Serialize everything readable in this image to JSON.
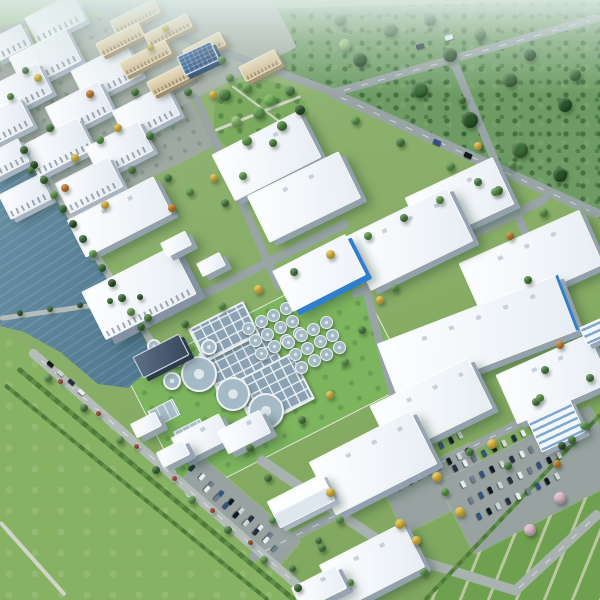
{
  "scene": {
    "size": [
      600,
      600
    ],
    "palette": {
      "ground": "#86ac64",
      "forest": "#6d9b63",
      "field": "#87b163",
      "crop": "#6fa04f",
      "crop_stripe": "#b9c8a0",
      "water_light": "#6d93a6",
      "water_dark": "#35566f",
      "road": "#98a5a4",
      "road_light": "#b5bdbb",
      "roof_white": "#f6f9fc",
      "facade_shadow": "#a9b4c2",
      "accent_blue": "#2f7fd0",
      "solar_blue": "#1c3e69",
      "dorm_tan": "#cdb78d",
      "lawn": "#7db45e",
      "tank_rim": "#eef2f5",
      "tank_water": "#a5bac7",
      "haze": "#dfece9"
    },
    "tree_palette": [
      "#4c8040",
      "#3a6b36",
      "#5f9a4c",
      "#2a5429",
      "#6fae58",
      "#e0bc3f",
      "#c9822e",
      "#a84b2d",
      "#d9b8c9",
      "#8fbf72"
    ],
    "car_palette": [
      "#223140",
      "#e8edf1",
      "#6f8091",
      "#32527e",
      "#101820",
      "#cfd6db"
    ],
    "pads": [
      [
        82,
        118,
        210,
        170,
        -27,
        "pad"
      ],
      [
        185,
        48,
        200,
        100,
        -27,
        "padl"
      ],
      [
        268,
        378,
        250,
        135,
        -27,
        "lawn"
      ],
      [
        175,
        85,
        45,
        18,
        -27,
        "lot"
      ],
      [
        240,
        512,
        130,
        34,
        41,
        "lot"
      ],
      [
        438,
        488,
        100,
        52,
        -27,
        "lot"
      ],
      [
        532,
        480,
        170,
        80,
        -27,
        "lot"
      ]
    ],
    "roads_a": [
      [
        330,
        92,
        600,
        215,
        10,
        "road",
        1
      ],
      [
        333,
        93,
        600,
        17,
        8,
        "road",
        1
      ],
      [
        95,
        5,
        338,
        94,
        8,
        "road",
        0
      ],
      [
        0,
        30,
        98,
        6,
        7,
        "road",
        0
      ],
      [
        136,
        328,
        348,
        222,
        9,
        "road",
        0
      ],
      [
        352,
        295,
        548,
        197,
        9,
        "road",
        0
      ],
      [
        250,
        558,
        600,
        382,
        9,
        "road",
        1
      ],
      [
        195,
        95,
        280,
        290,
        8,
        "road",
        0
      ],
      [
        360,
        265,
        402,
        430,
        8,
        "road",
        0
      ],
      [
        452,
        58,
        545,
        280,
        8,
        "road",
        0
      ],
      [
        548,
        288,
        595,
        390,
        8,
        "road",
        0
      ],
      [
        215,
        130,
        300,
        96,
        2.5,
        "path",
        0
      ],
      [
        232,
        86,
        288,
        128,
        2,
        "path",
        0
      ]
    ],
    "roads_b": [
      [
        26,
        146,
        152,
        342,
        7,
        "roadl",
        0
      ],
      [
        30,
        350,
        315,
        600,
        9,
        "roadl",
        1
      ],
      [
        0,
        318,
        150,
        297,
        5,
        "roadl",
        0
      ],
      [
        258,
        458,
        400,
        555,
        10,
        "roadm",
        0
      ],
      [
        395,
        553,
        520,
        592,
        10,
        "roadm",
        0
      ],
      [
        515,
        591,
        600,
        512,
        10,
        "roadm",
        1
      ],
      [
        0,
        522,
        65,
        595,
        4,
        "path",
        0
      ],
      [
        18,
        368,
        295,
        600,
        5,
        "hedge",
        0
      ],
      [
        5,
        385,
        268,
        600,
        4,
        "hedge",
        0
      ],
      [
        425,
        600,
        600,
        415,
        4,
        "hedge",
        0
      ]
    ],
    "buildings": [
      [
        54,
        18,
        52,
        28,
        -27,
        "m"
      ],
      [
        8,
        42,
        36,
        22,
        -27,
        "m"
      ],
      [
        44,
        58,
        62,
        34,
        -27,
        "m"
      ],
      [
        17,
        90,
        58,
        32,
        -27,
        "m"
      ],
      [
        2,
        122,
        50,
        30,
        -27,
        "m"
      ],
      [
        105,
        72,
        60,
        34,
        -27,
        "m"
      ],
      [
        78,
        108,
        58,
        32,
        -27,
        "m"
      ],
      [
        57,
        146,
        60,
        34,
        -27,
        "m"
      ],
      [
        5,
        158,
        38,
        24,
        -27,
        "m"
      ],
      [
        145,
        112,
        58,
        32,
        -27,
        "m"
      ],
      [
        118,
        148,
        58,
        32,
        -27,
        "m"
      ],
      [
        88,
        184,
        58,
        32,
        -27,
        "m"
      ],
      [
        24,
        196,
        44,
        26,
        -27,
        "m"
      ],
      [
        134,
        15,
        48,
        13,
        -27,
        "d"
      ],
      [
        119,
        38,
        46,
        13,
        -27,
        "d"
      ],
      [
        167,
        29,
        46,
        13,
        -27,
        "d"
      ],
      [
        144,
        57,
        50,
        14,
        -27,
        "d"
      ],
      [
        171,
        77,
        48,
        14,
        -27,
        "d"
      ],
      [
        203,
        46,
        40,
        13,
        -27,
        "d"
      ],
      [
        259,
        64,
        38,
        15,
        -27,
        "d"
      ],
      [
        197,
        57,
        36,
        19,
        -25,
        "s"
      ],
      [
        118,
        216,
        95,
        40,
        -27,
        "w"
      ],
      [
        138,
        292,
        100,
        52,
        -27,
        "p"
      ],
      [
        265,
        155,
        95,
        50,
        -27,
        "w"
      ],
      [
        303,
        196,
        100,
        50,
        -26,
        "w"
      ],
      [
        458,
        200,
        95,
        50,
        -25,
        "w"
      ],
      [
        530,
        263,
        130,
        58,
        -24,
        "w"
      ],
      [
        408,
        238,
        112,
        58,
        -26,
        "w"
      ],
      [
        318,
        272,
        80,
        44,
        -27,
        "b"
      ],
      [
        476,
        336,
        190,
        58,
        -21,
        "W"
      ],
      [
        552,
        378,
        100,
        52,
        -24,
        "w"
      ],
      [
        430,
        406,
        108,
        54,
        -26,
        "w"
      ],
      [
        372,
        462,
        112,
        58,
        -27,
        "w"
      ],
      [
        371,
        565,
        92,
        48,
        -27,
        "w"
      ],
      [
        200,
        437,
        52,
        26,
        -27,
        "w"
      ],
      [
        243,
        431,
        46,
        24,
        -27,
        "w"
      ],
      [
        318,
        587,
        48,
        24,
        -27,
        "w"
      ],
      [
        300,
        500,
        60,
        28,
        -27,
        "g"
      ],
      [
        555,
        425,
        46,
        34,
        -25,
        "o"
      ],
      [
        595,
        330,
        26,
        18,
        -24,
        "o"
      ],
      [
        160,
        355,
        50,
        22,
        -27,
        "t"
      ],
      [
        175,
        243,
        26,
        14,
        -27,
        "w"
      ],
      [
        210,
        263,
        24,
        13,
        -27,
        "w"
      ],
      [
        145,
        424,
        26,
        14,
        -27,
        "w"
      ],
      [
        172,
        452,
        28,
        15,
        -27,
        "w"
      ]
    ],
    "treatment": {
      "tanks": [
        [
          197,
          372,
          16
        ],
        [
          231,
          392,
          15
        ],
        [
          264,
          409,
          16
        ],
        [
          170,
          379,
          7
        ],
        [
          174,
          357,
          6
        ],
        [
          152,
          344,
          5
        ],
        [
          207,
          345,
          6
        ]
      ],
      "clusters": [
        [
          273,
          330,
          4,
          3,
          14,
          5.5,
          -27
        ],
        [
          313,
          344,
          4,
          3,
          14,
          5.5,
          -27
        ]
      ],
      "basins": [
        [
          239,
          357,
          68,
          44,
          -27
        ],
        [
          271,
          389,
          64,
          48,
          -27
        ],
        [
          222,
          330,
          58,
          34,
          -27
        ]
      ],
      "pools": [
        [
          163,
          412,
          26,
          16,
          -27
        ],
        [
          190,
          433,
          28,
          18,
          -27
        ]
      ]
    },
    "car_rows": [
      [
        455,
        468,
        -27,
        11,
        11,
        1,
        1
      ],
      [
        463,
        484,
        -27,
        11,
        11,
        1,
        1
      ],
      [
        471,
        500,
        -27,
        10,
        11,
        1,
        1
      ],
      [
        479,
        516,
        -27,
        9,
        11,
        1,
        1
      ],
      [
        392,
        470,
        -27,
        8,
        11,
        1,
        1
      ],
      [
        400,
        486,
        -27,
        8,
        11,
        1,
        1
      ],
      [
        192,
        468,
        41,
        9,
        13,
        1,
        1
      ],
      [
        207,
        489,
        41,
        8,
        13,
        1,
        1
      ],
      [
        158,
        82,
        -27,
        6,
        8,
        1,
        0.8
      ],
      [
        437,
        142,
        24,
        3,
        34,
        0,
        1.3
      ],
      [
        50,
        364,
        41,
        4,
        14,
        0,
        1
      ],
      [
        556,
        303,
        65,
        3,
        18,
        0,
        1
      ],
      [
        420,
        46,
        -16,
        2,
        30,
        0,
        1.2
      ]
    ],
    "trees": [
      [
        24,
        150,
        4,
        1
      ],
      [
        34,
        165,
        4,
        3
      ],
      [
        44,
        180,
        4,
        1
      ],
      [
        54,
        195,
        4,
        2
      ],
      [
        63,
        209,
        4,
        1
      ],
      [
        73,
        224,
        4,
        3
      ],
      [
        83,
        239,
        4,
        1
      ],
      [
        93,
        254,
        4,
        2
      ],
      [
        102,
        268,
        4,
        1
      ],
      [
        112,
        283,
        4,
        3
      ],
      [
        122,
        298,
        4,
        1
      ],
      [
        131,
        312,
        4,
        2
      ],
      [
        141,
        327,
        4,
        1
      ],
      [
        20,
        313,
        3,
        3
      ],
      [
        50,
        309,
        3,
        1
      ],
      [
        80,
        305,
        3,
        3
      ],
      [
        110,
        301,
        3,
        1
      ],
      [
        140,
        297,
        3,
        3
      ],
      [
        48,
        378,
        4,
        2
      ],
      [
        84,
        408,
        4,
        0
      ],
      [
        120,
        440,
        4,
        2
      ],
      [
        156,
        470,
        4,
        1
      ],
      [
        192,
        500,
        4,
        2
      ],
      [
        228,
        530,
        4,
        0
      ],
      [
        264,
        560,
        4,
        2
      ],
      [
        298,
        588,
        4,
        1
      ],
      [
        60,
        381,
        2.5,
        7
      ],
      [
        98,
        413,
        2.5,
        7
      ],
      [
        136,
        446,
        2.5,
        7
      ],
      [
        174,
        478,
        2.5,
        7
      ],
      [
        212,
        510,
        2.5,
        7
      ],
      [
        250,
        542,
        2.5,
        7
      ],
      [
        225,
        95,
        6,
        0
      ],
      [
        247,
        88,
        5,
        2
      ],
      [
        270,
        100,
        6,
        4
      ],
      [
        290,
        91,
        5,
        0
      ],
      [
        236,
        121,
        5,
        9
      ],
      [
        259,
        113,
        6,
        2
      ],
      [
        282,
        126,
        5,
        0
      ],
      [
        300,
        110,
        5,
        3
      ],
      [
        247,
        141,
        5,
        2
      ],
      [
        273,
        143,
        4,
        0
      ],
      [
        38,
        78,
        4,
        5
      ],
      [
        90,
        94,
        4,
        6
      ],
      [
        118,
        128,
        4,
        5
      ],
      [
        75,
        158,
        4,
        5
      ],
      [
        50,
        128,
        4,
        0
      ],
      [
        25,
        70,
        3.5,
        0
      ],
      [
        100,
        140,
        4,
        2
      ],
      [
        135,
        92,
        4,
        0
      ],
      [
        10,
        96,
        3.5,
        2
      ],
      [
        150,
        136,
        4,
        0
      ],
      [
        65,
        188,
        4,
        6
      ],
      [
        30,
        170,
        3.5,
        0
      ],
      [
        132,
        170,
        4,
        0
      ],
      [
        105,
        205,
        4,
        5
      ],
      [
        165,
        28,
        3.5,
        5
      ],
      [
        150,
        47,
        3.5,
        5
      ],
      [
        222,
        60,
        4,
        0
      ],
      [
        230,
        78,
        4,
        2
      ],
      [
        188,
        92,
        4,
        0
      ],
      [
        213,
        95,
        4,
        5
      ],
      [
        168,
        178,
        4,
        0
      ],
      [
        190,
        192,
        4,
        2
      ],
      [
        214,
        178,
        4,
        5
      ],
      [
        172,
        208,
        4,
        6
      ],
      [
        225,
        203,
        4,
        0
      ],
      [
        243,
        176,
        4,
        2
      ],
      [
        355,
        120,
        4.5,
        2
      ],
      [
        400,
        142,
        4.5,
        0
      ],
      [
        450,
        166,
        4.5,
        2
      ],
      [
        498,
        190,
        4.5,
        0
      ],
      [
        543,
        212,
        4.5,
        2
      ],
      [
        185,
        324,
        4,
        0
      ],
      [
        222,
        306,
        4,
        2
      ],
      [
        258,
        289,
        4.5,
        5
      ],
      [
        294,
        272,
        4,
        0
      ],
      [
        330,
        254,
        4.5,
        5
      ],
      [
        368,
        236,
        4,
        2
      ],
      [
        404,
        218,
        4,
        0
      ],
      [
        440,
        200,
        4,
        2
      ],
      [
        478,
        182,
        4,
        0
      ],
      [
        512,
        165,
        4,
        2
      ],
      [
        462,
        100,
        4,
        0
      ],
      [
        478,
        146,
        4,
        5
      ],
      [
        495,
        192,
        4,
        2
      ],
      [
        510,
        236,
        4,
        6
      ],
      [
        528,
        280,
        4,
        0
      ],
      [
        380,
        300,
        4,
        5
      ],
      [
        362,
        330,
        4,
        0
      ],
      [
        395,
        288,
        4,
        2
      ],
      [
        560,
        345,
        4,
        6
      ],
      [
        545,
        370,
        4,
        0
      ],
      [
        148,
        318,
        4,
        0
      ],
      [
        302,
        420,
        4,
        0
      ],
      [
        330,
        395,
        4,
        5
      ],
      [
        345,
        362,
        4,
        2
      ],
      [
        250,
        448,
        4,
        0
      ],
      [
        268,
        478,
        4,
        0
      ],
      [
        330,
        492,
        4.5,
        5
      ],
      [
        340,
        520,
        4,
        2
      ],
      [
        318,
        540,
        3.5,
        0
      ],
      [
        272,
        520,
        3.5,
        2
      ],
      [
        322,
        548,
        4,
        0
      ],
      [
        416,
        540,
        4.5,
        5
      ],
      [
        424,
        572,
        4,
        2
      ],
      [
        437,
        477,
        5,
        5
      ],
      [
        460,
        512,
        5,
        5
      ],
      [
        492,
        444,
        5,
        5
      ],
      [
        400,
        524,
        5,
        5
      ],
      [
        470,
        452,
        4,
        0
      ],
      [
        445,
        492,
        4,
        2
      ],
      [
        508,
        466,
        4,
        0
      ],
      [
        560,
        498,
        6,
        8
      ],
      [
        530,
        530,
        6,
        8
      ],
      [
        557,
        464,
        4,
        6
      ],
      [
        584,
        425,
        4.5,
        2
      ],
      [
        562,
        446,
        4,
        3
      ],
      [
        536,
        402,
        4,
        0
      ],
      [
        572,
        440,
        4,
        0
      ],
      [
        540,
        398,
        4,
        2
      ],
      [
        590,
        378,
        4,
        0
      ],
      [
        292,
        568,
        3.5,
        0
      ],
      [
        350,
        582,
        3.5,
        2
      ],
      [
        360,
        60,
        7,
        3
      ],
      [
        420,
        90,
        8,
        1
      ],
      [
        470,
        120,
        8,
        3
      ],
      [
        520,
        150,
        8,
        1
      ],
      [
        560,
        175,
        7,
        3
      ],
      [
        390,
        30,
        7,
        1
      ],
      [
        450,
        55,
        7,
        3
      ],
      [
        510,
        80,
        7,
        1
      ],
      [
        565,
        105,
        7,
        3
      ],
      [
        340,
        20,
        6,
        1
      ],
      [
        430,
        20,
        6,
        3
      ],
      [
        480,
        35,
        6,
        1
      ],
      [
        530,
        55,
        6,
        3
      ],
      [
        575,
        75,
        6,
        1
      ],
      [
        345,
        45,
        6,
        9
      ]
    ]
  }
}
